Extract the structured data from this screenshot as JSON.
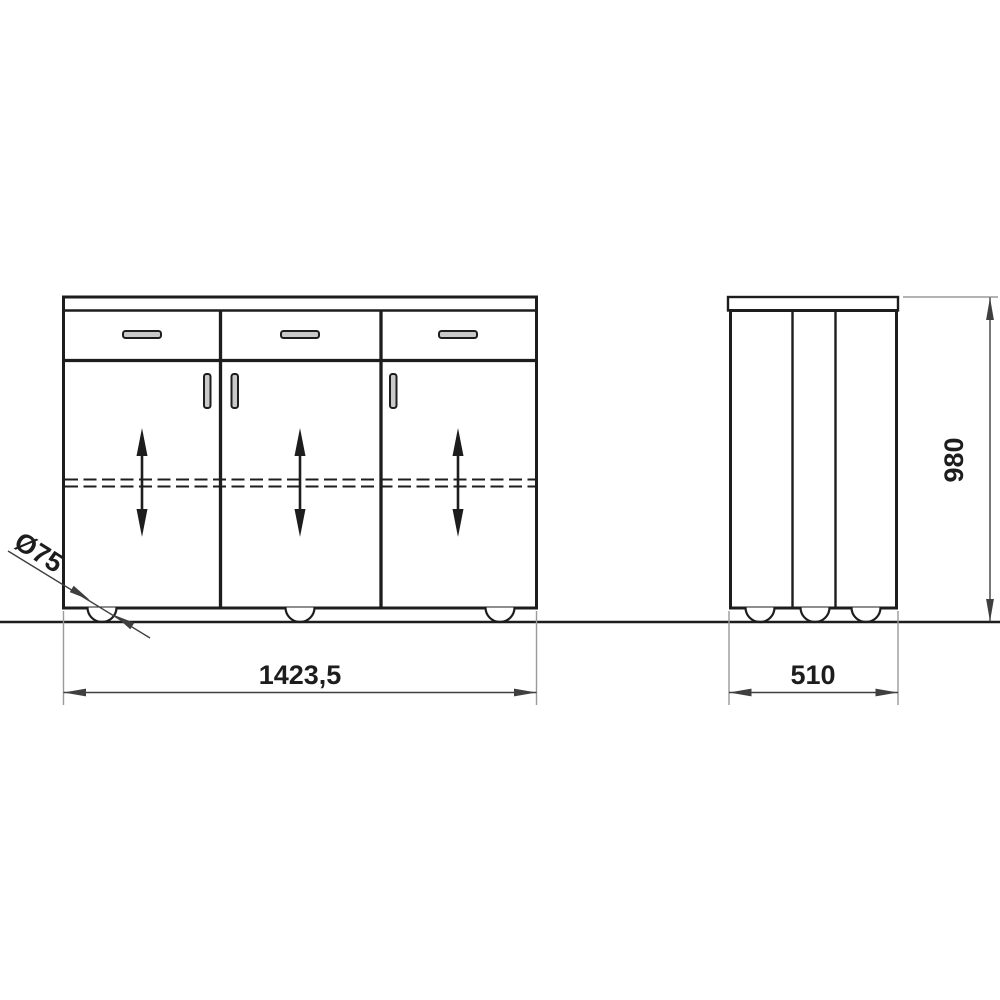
{
  "drawing": {
    "kind": "furniture-dimension-drawing",
    "labels": {
      "overall_width": "1423,5",
      "depth": "510",
      "height": "980",
      "caster_diameter": "Ø75"
    },
    "views": {
      "front": {
        "drawer_count": 3,
        "door_count": 3,
        "wheel_count": 3
      },
      "side": {
        "panel_section_count": 3,
        "wheel_count": 3
      }
    },
    "colors": {
      "line": "#1d1d1d",
      "dimension_line": "#3f3f3f",
      "extension_line": "#9a9a9a",
      "handle_fill": "#c9c9c9",
      "background": "#ffffff"
    }
  }
}
